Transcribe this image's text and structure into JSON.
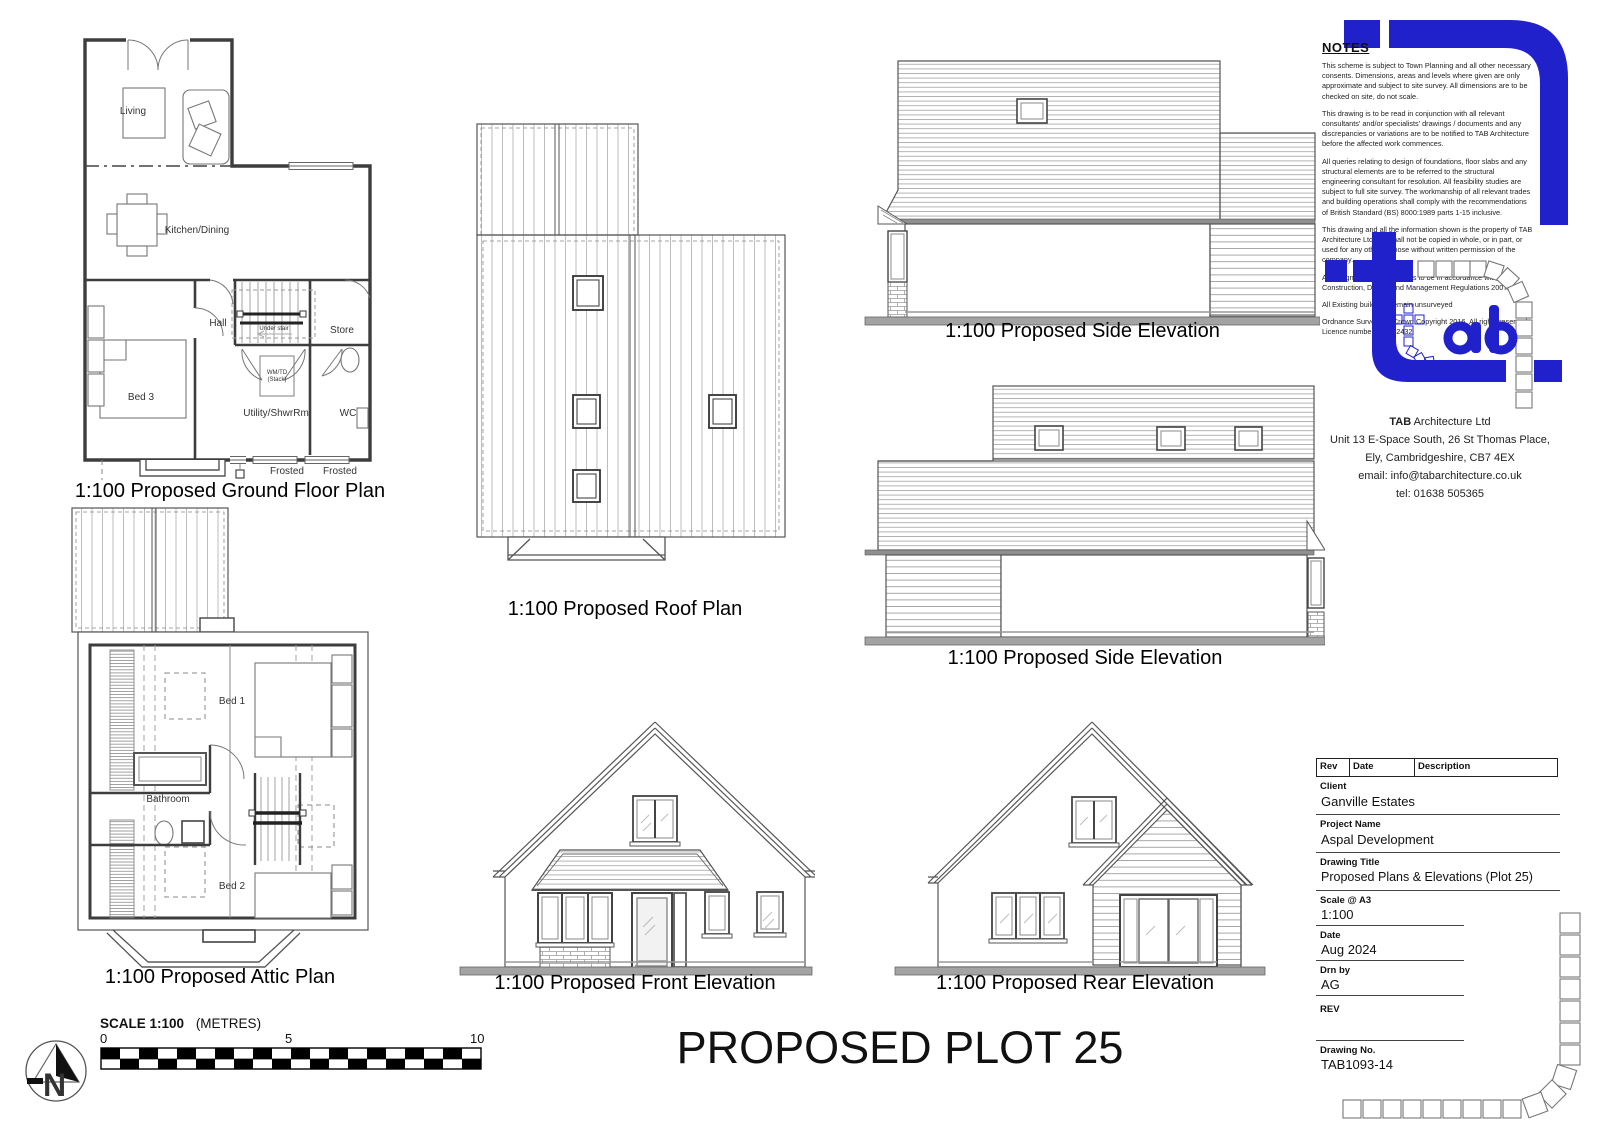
{
  "sheet": {
    "big_title": "PROPOSED PLOT 25"
  },
  "captions": {
    "ground_floor": "1:100 Proposed Ground Floor Plan",
    "attic": "1:100 Proposed Attic Plan",
    "roof": "1:100 Proposed Roof Plan",
    "side1": "1:100 Proposed Side Elevation",
    "side2": "1:100 Proposed Side Elevation",
    "front": "1:100 Proposed Front Elevation",
    "rear": "1:100 Proposed Rear Elevation"
  },
  "gf": {
    "living": "Living",
    "kitchen": "Kitchen/Dining",
    "hall": "Hall",
    "store": "Store",
    "bed3": "Bed 3",
    "utility": "Utility/ShwrRm",
    "wc": "WC",
    "frosted1": "Frosted",
    "frosted2": "Frosted",
    "wm1": "WM/TD",
    "wm2": "(Stack)",
    "understair": "Under stair"
  },
  "attic": {
    "bed1": "Bed 1",
    "bathroom": "Bathroom",
    "bed2": "Bed 2"
  },
  "notes": {
    "heading": "NOTES",
    "paragraphs": [
      "This scheme is subject to Town Planning and all other necessary consents. Dimensions, areas and levels where given are only approximate and subject to site survey. All dimensions are to be checked on site, do not scale.",
      "This drawing is to be read in conjunction with all relevant consultants' and/or specialists' drawings / documents and any discrepancies or variations are to be notified to TAB Architecture before the affected work commences.",
      "All queries relating to design of foundations, floor slabs and any structural elements are to be referred to the structural engineering consultant for resolution.  All feasibility studies are subject to full site survey. The workmanship of all relevant trades and building operations shall comply with the recommendations of British Standard (BS) 8000:1989 parts 1-15 inclusive.",
      "This drawing and all the information shown is the property of TAB Architecture Ltd and shall not be copied in whole, or in part, or used for any other purpose without written permission of the company.",
      "All design and construction is to be in accordance with the Construction, Design and Management Regulations 2007.",
      "All Existing buildings remain unsurveyed",
      "Ordnance Survey, (c) Crown Copyright 2016. All rights reserved. Licence number 100022432"
    ]
  },
  "firm": {
    "name_bold": "TAB",
    "name_rest": " Architecture Ltd",
    "address1": "Unit 13 E-Space South, 26 St Thomas Place,",
    "address2": "Ely, Cambridgeshire, CB7 4EX",
    "email": "email: info@tabarchitecture.co.uk",
    "tel": "tel: 01638 505365"
  },
  "titleblock": {
    "col_rev": "Rev",
    "col_date": "Date",
    "col_description": "Description",
    "client_label": "Client",
    "client": "Ganville Estates",
    "project_label": "Project Name",
    "project": "Aspal Development",
    "drawing_title_label": "Drawing Title",
    "drawing_title": "Proposed Plans & Elevations (Plot 25)",
    "scale_label": "Scale @ A3",
    "scale": "1:100",
    "date_label": "Date",
    "date": "Aug 2024",
    "drnby_label": "Drn by",
    "drnby": "AG",
    "rev_label": "REV",
    "drawingno_label": "Drawing No.",
    "drawingno": "TAB1093-14"
  },
  "scalebar": {
    "label_bold": "SCALE 1:100",
    "label_units": "(METRES)",
    "tick0": "0",
    "tick5": "5",
    "tick10": "10"
  },
  "north": {
    "letter": "N"
  },
  "colors": {
    "brand_blue": "#2121CC",
    "line_gray": "#555555",
    "ground_gray": "#9a9a9a"
  }
}
